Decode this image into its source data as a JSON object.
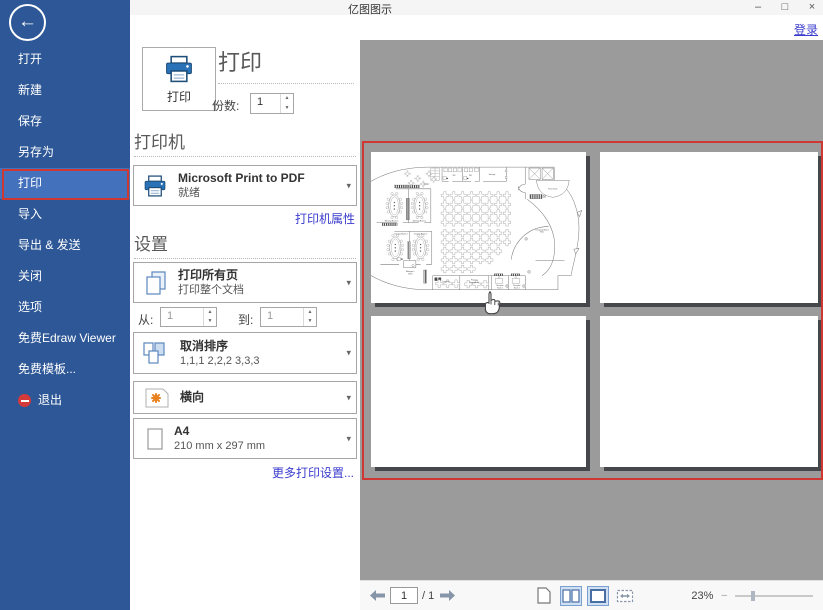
{
  "colors": {
    "sidebar_blue": "#2d5796",
    "selected_blue": "#4471bc",
    "annotation_red": "#cf3732",
    "link_blue": "#3a3ccd",
    "preview_gray": "#9b9b9b"
  },
  "titlebar": {
    "title": "亿图图示",
    "minimize": "–",
    "maximize": "□",
    "close": "×"
  },
  "header": {
    "login": "登录"
  },
  "sidebar": {
    "items": [
      {
        "label": "打开"
      },
      {
        "label": "新建"
      },
      {
        "label": "保存"
      },
      {
        "label": "另存为"
      },
      {
        "label": "打印"
      },
      {
        "label": "导入"
      },
      {
        "label": "导出 & 发送"
      },
      {
        "label": "关闭"
      },
      {
        "label": "选项"
      },
      {
        "label": "免费Edraw Viewer"
      },
      {
        "label": "免费模板..."
      },
      {
        "label": "退出"
      }
    ]
  },
  "print_panel": {
    "print_button_label": "打印",
    "heading": "打印",
    "copies_label": "份数:",
    "copies_value": "1",
    "printer_section": "打印机",
    "printer_name": "Microsoft Print to PDF",
    "printer_status": "就绪",
    "printer_props_link": "打印机属性",
    "settings_section": "设置",
    "pages_title": "打印所有页",
    "pages_subtitle": "打印整个文档",
    "from_label": "从:",
    "from_value": "1",
    "to_label": "到:",
    "to_value": "1",
    "collate_title": "取消排序",
    "collate_subtitle": "1,1,1  2,2,2  3,3,3",
    "orientation_title": "横向",
    "paper_title": "A4",
    "paper_subtitle": "210 mm x 297 mm",
    "more_settings_link": "更多打印设置..."
  },
  "preview": {
    "page_count": 4,
    "plan_labels": {
      "lounge": "Lounge",
      "wc1": "WC",
      "wc2": "WC",
      "storage": "Storage",
      "front_desk": "Front Desk",
      "meeting2": "Meeting Room 2",
      "meeting1": "Meeting Room 1",
      "training2": "Training Room 2",
      "training1": "Training Room 1",
      "manager1": "Manager's",
      "manager2": "Office",
      "logistics": "Logistics",
      "finance1": "Finance",
      "finance2": "Department",
      "reception2a": "Reception",
      "reception2b": "Room 2",
      "reception1a": "Reception",
      "reception1b": "Room 1",
      "company1": "Company Name",
      "company2": "Here"
    }
  },
  "statusbar": {
    "page_value": "1",
    "page_total_label": "/ 1",
    "zoom_percent": "23%"
  }
}
